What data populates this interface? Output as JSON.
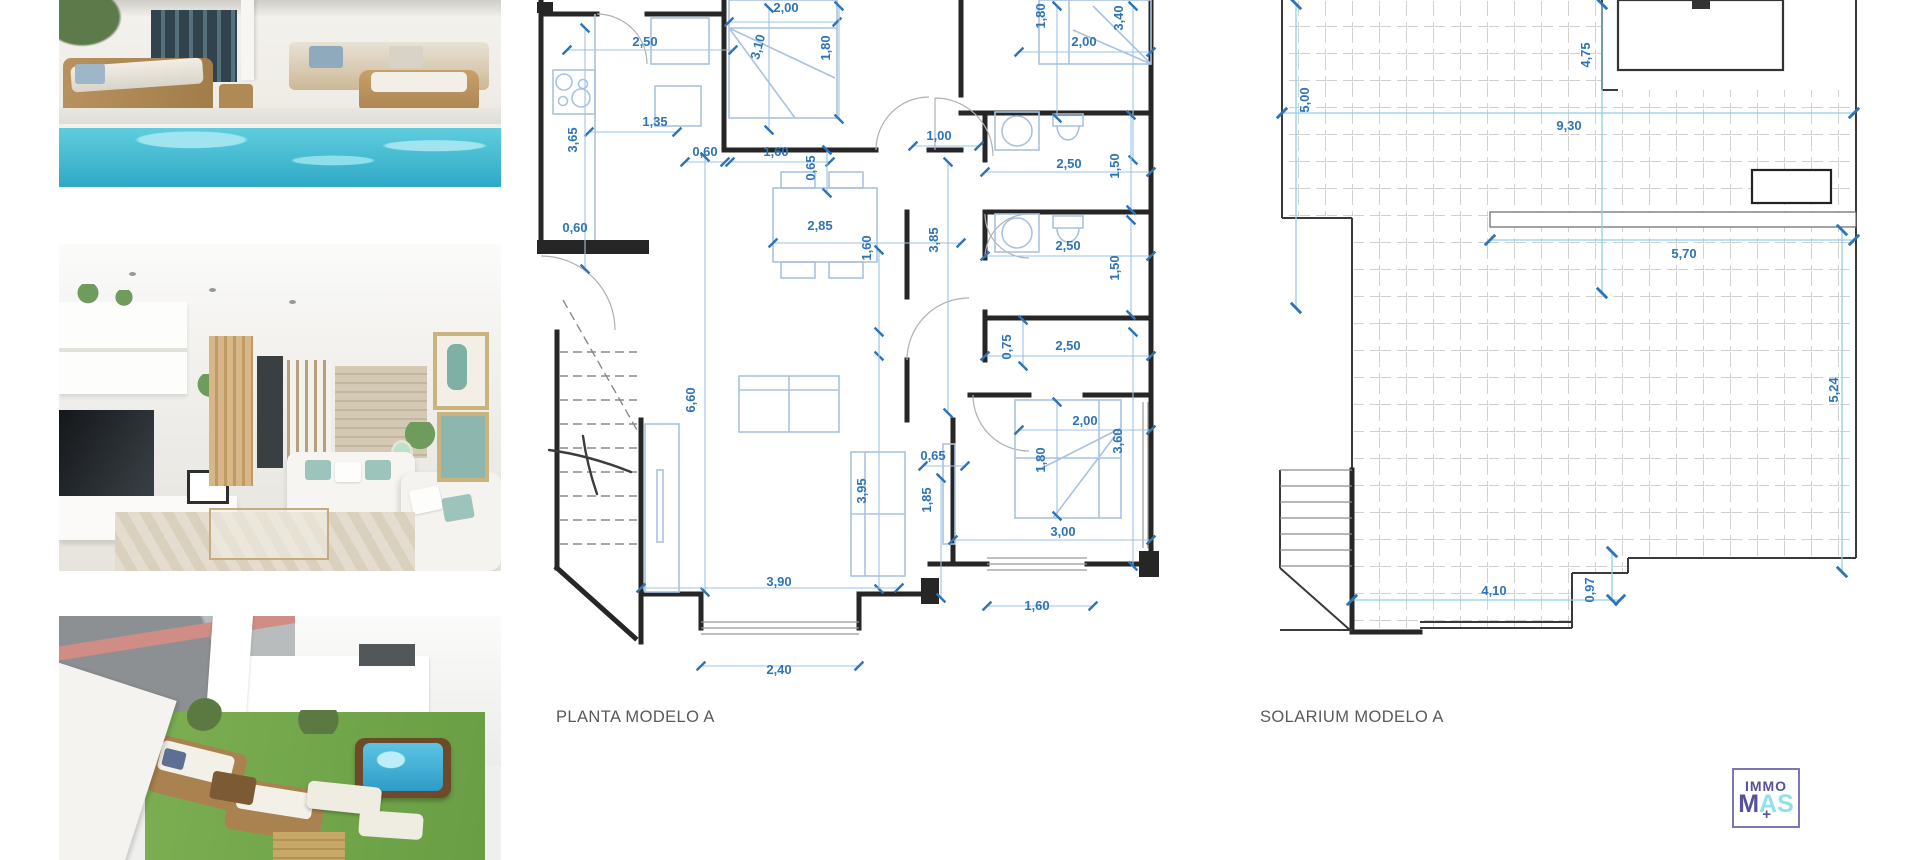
{
  "captions": {
    "floor_plan": "PLANTA MODELO A",
    "solarium": "SOLARIUM MODELO A"
  },
  "logo": {
    "immo": "IMMO",
    "m": "M",
    "a": "A",
    "s": "S",
    "plus": "+"
  },
  "colors": {
    "dim_text": "#2e74b6",
    "dim_line": "#9dc3e6",
    "cyan_line": "#8fd0e6",
    "wall": "#262626",
    "tile_grid": "#b4b4b4",
    "caption": "#595959",
    "furniture": "#a9c2e0",
    "logo_purple": "#57519b",
    "logo_cyan": "#8fe1ea",
    "pool": "#2fa9c6",
    "lawn": "#7cae52"
  },
  "photos": [
    {
      "name": "pool-terrace"
    },
    {
      "name": "living-room"
    },
    {
      "name": "aerial-garden"
    }
  ],
  "floor_plan": {
    "dims": [
      {
        "t": "2,50",
        "x": 112,
        "y": 46,
        "r": 0
      },
      {
        "t": "1,35",
        "x": 122,
        "y": 126,
        "r": 0
      },
      {
        "t": "3,65",
        "x": 44,
        "y": 140,
        "r": -90
      },
      {
        "t": "0,60",
        "x": 172,
        "y": 156,
        "r": 0
      },
      {
        "t": "0,60",
        "x": 42,
        "y": 232,
        "r": 0
      },
      {
        "t": "1,60",
        "x": 243,
        "y": 156,
        "r": 0
      },
      {
        "t": "0,65",
        "x": 282,
        "y": 168,
        "r": -90
      },
      {
        "t": "2,00",
        "x": 253,
        "y": 12,
        "r": 0
      },
      {
        "t": "3,10",
        "x": 229,
        "y": 48,
        "r": -75
      },
      {
        "t": "1,80",
        "x": 297,
        "y": 48,
        "r": -90
      },
      {
        "t": "1,00",
        "x": 406,
        "y": 140,
        "r": 0
      },
      {
        "t": "2,00",
        "x": 551,
        "y": 46,
        "r": 0
      },
      {
        "t": "1,80",
        "x": 512,
        "y": 16,
        "r": -90
      },
      {
        "t": "3,40",
        "x": 590,
        "y": 18,
        "r": -90
      },
      {
        "t": "2,50",
        "x": 536,
        "y": 168,
        "r": 0
      },
      {
        "t": "1,50",
        "x": 586,
        "y": 166,
        "r": -90
      },
      {
        "t": "2,85",
        "x": 287,
        "y": 230,
        "r": 0
      },
      {
        "t": "1,60",
        "x": 338,
        "y": 248,
        "r": -90
      },
      {
        "t": "3,85",
        "x": 405,
        "y": 240,
        "r": -90
      },
      {
        "t": "2,50",
        "x": 535,
        "y": 250,
        "r": 0
      },
      {
        "t": "1,50",
        "x": 586,
        "y": 268,
        "r": -90
      },
      {
        "t": "0,75",
        "x": 478,
        "y": 347,
        "r": -90
      },
      {
        "t": "2,50",
        "x": 535,
        "y": 350,
        "r": 0
      },
      {
        "t": "6,60",
        "x": 162,
        "y": 400,
        "r": -90
      },
      {
        "t": "3,95",
        "x": 333,
        "y": 491,
        "r": -90
      },
      {
        "t": "0,65",
        "x": 400,
        "y": 460,
        "r": 0
      },
      {
        "t": "1,85",
        "x": 398,
        "y": 500,
        "r": -90
      },
      {
        "t": "2,00",
        "x": 552,
        "y": 425,
        "r": 0
      },
      {
        "t": "1,80",
        "x": 512,
        "y": 460,
        "r": -90
      },
      {
        "t": "3,60",
        "x": 589,
        "y": 441,
        "r": -90
      },
      {
        "t": "3,00",
        "x": 530,
        "y": 536,
        "r": 0
      },
      {
        "t": "1,60",
        "x": 504,
        "y": 610,
        "r": 0
      },
      {
        "t": "3,90",
        "x": 246,
        "y": 586,
        "r": 0
      },
      {
        "t": "2,40",
        "x": 246,
        "y": 674,
        "r": 0
      }
    ]
  },
  "solarium": {
    "dims": [
      {
        "t": "5,00",
        "x": 37,
        "y": 100,
        "r": -90
      },
      {
        "t": "4,75",
        "x": 318,
        "y": 55,
        "r": -90
      },
      {
        "t": "9,30",
        "x": 297,
        "y": 130,
        "r": 0
      },
      {
        "t": "5,70",
        "x": 412,
        "y": 258,
        "r": 0
      },
      {
        "t": "5,24",
        "x": 566,
        "y": 390,
        "r": -90
      },
      {
        "t": "4,10",
        "x": 222,
        "y": 595,
        "r": 0
      },
      {
        "t": "0,97",
        "x": 322,
        "y": 590,
        "r": -90
      }
    ]
  }
}
